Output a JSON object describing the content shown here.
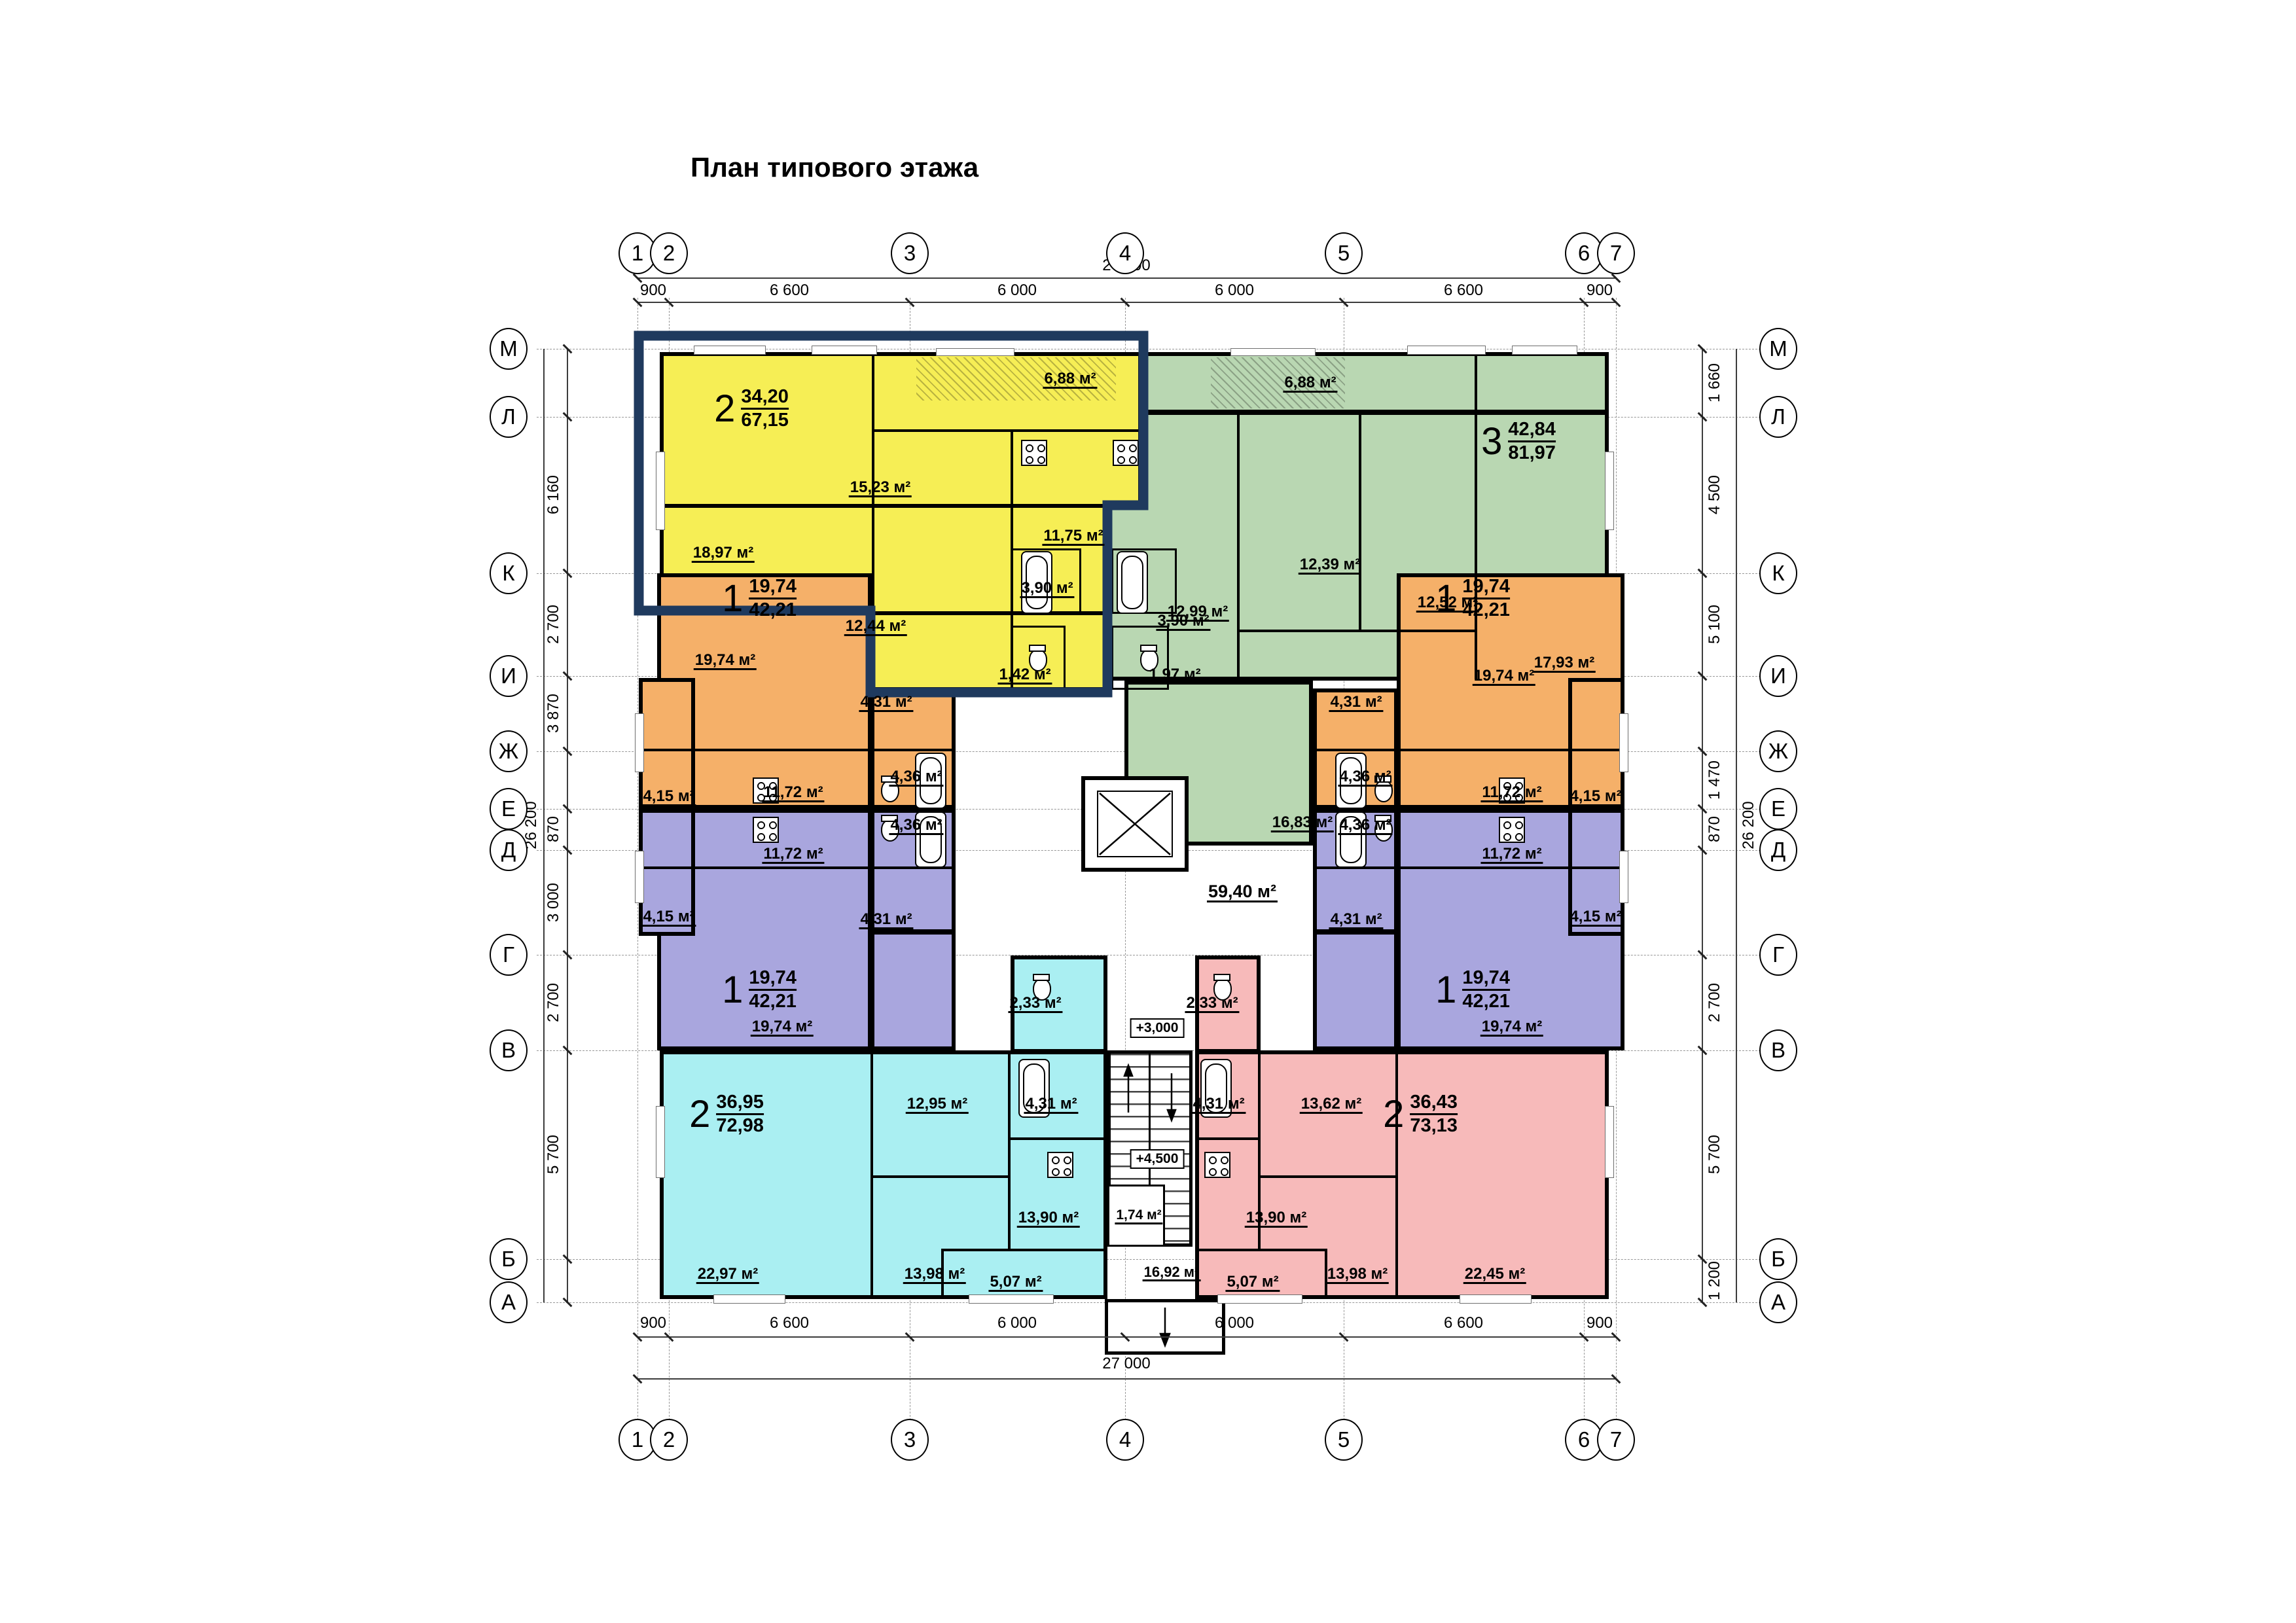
{
  "title": "План типового этажа",
  "colors": {
    "yellow": "#f6ee55",
    "green": "#b9d7b2",
    "orange": "#f5b069",
    "purple": "#a9a6de",
    "cyan": "#aaeff2",
    "pink": "#f7baba",
    "selection_outline": "#1f3a5e",
    "wall": "#000000"
  },
  "axes": {
    "top": [
      "1",
      "2",
      "3",
      "4",
      "5",
      "6",
      "7"
    ],
    "bottom": [
      "1",
      "2",
      "3",
      "4",
      "5",
      "6",
      "7"
    ],
    "left": [
      "М",
      "Л",
      "К",
      "И",
      "Ж",
      "Е",
      "Д",
      "Г",
      "В",
      "Б",
      "А"
    ],
    "right": [
      "М",
      "Л",
      "К",
      "И",
      "Ж",
      "Е",
      "Д",
      "Г",
      "В",
      "Б",
      "А"
    ]
  },
  "dims": {
    "top_total": "27 000",
    "top_segs": [
      "900",
      "6 600",
      "6 000",
      "6 000",
      "6 600",
      "900"
    ],
    "bottom_total": "27 000",
    "bottom_segs": [
      "900",
      "6 600",
      "6 000",
      "6 000",
      "6 600",
      "900"
    ],
    "left": [
      "6 160",
      "2 700",
      "3 870",
      "870",
      "3 000",
      "2 700",
      "5 700"
    ],
    "left_total": "26 200",
    "right": [
      "1 660",
      "4 500",
      "5 100",
      "1 470",
      "870",
      "2 700",
      "5 700",
      "1 200"
    ],
    "right_total": "26 200"
  },
  "apartments": {
    "yellow": {
      "rooms": "2",
      "living": "34,20",
      "total": "67,15",
      "areas": {
        "r1": "18,97 м²",
        "r2": "15,23 м²",
        "balcony": "6,88 м²",
        "kitchen": "11,75 м²",
        "bath": "3,90 м²",
        "hall": "12,44 м²",
        "wc": "1,42 м²"
      }
    },
    "green": {
      "rooms": "3",
      "living": "42,84",
      "total": "81,97",
      "areas": {
        "balcony": "6,88 м²",
        "r1": "12,99 м²",
        "r2": "12,39 м²",
        "r3": "12,52 м²",
        "r4": "17,93 м²",
        "hall": "16,83 м²",
        "bath": "3,90 м²",
        "wc": "1,97 м²"
      }
    },
    "orange_left": {
      "rooms": "1",
      "living": "19,74",
      "total": "42,21",
      "areas": {
        "room": "19,74 м²",
        "hall": "4,31 м²",
        "bath": "4,36 м²",
        "kitchen": "11,72 м²",
        "loggia": "4,15 м²"
      }
    },
    "orange_right": {
      "rooms": "1",
      "living": "19,74",
      "total": "42,21",
      "areas": {
        "room": "19,74 м²",
        "hall": "4,31 м²",
        "bath": "4,36 м²",
        "kitchen": "11,72 м²",
        "loggia": "4,15 м²"
      }
    },
    "purple_left": {
      "rooms": "1",
      "living": "19,74",
      "total": "42,21",
      "areas": {
        "room": "19,74 м²",
        "hall": "4,31 м²",
        "bath": "4,36 м²",
        "kitchen": "11,72 м²",
        "loggia": "4,15 м²"
      }
    },
    "purple_right": {
      "rooms": "1",
      "living": "19,74",
      "total": "42,21",
      "areas": {
        "room": "19,74 м²",
        "hall": "4,31 м²",
        "bath": "4,36 м²",
        "kitchen": "11,72 м²",
        "loggia": "4,15 м²"
      }
    },
    "cyan": {
      "rooms": "2",
      "living": "36,95",
      "total": "72,98",
      "areas": {
        "living": "22,97 м²",
        "r2": "13,98 м²",
        "r1": "12,95 м²",
        "bath": "4,31 м²",
        "wc": "2,33 м²",
        "kitchen": "13,90 м²",
        "balcony": "5,07 м²"
      }
    },
    "pink": {
      "rooms": "2",
      "living": "36,43",
      "total": "73,13",
      "areas": {
        "wc": "2,33 м²",
        "bath": "4,31 м²",
        "r1": "13,62 м²",
        "kitchen": "13,90 м²",
        "r2": "13,98 м²",
        "living": "22,45 м²",
        "balcony": "5,07 м²"
      }
    }
  },
  "core": {
    "corridor": "59,40 м²",
    "chute": "1,74 м²",
    "lobby": "16,92 м²",
    "level_up": "+3,000",
    "level_down": "+4,500"
  }
}
